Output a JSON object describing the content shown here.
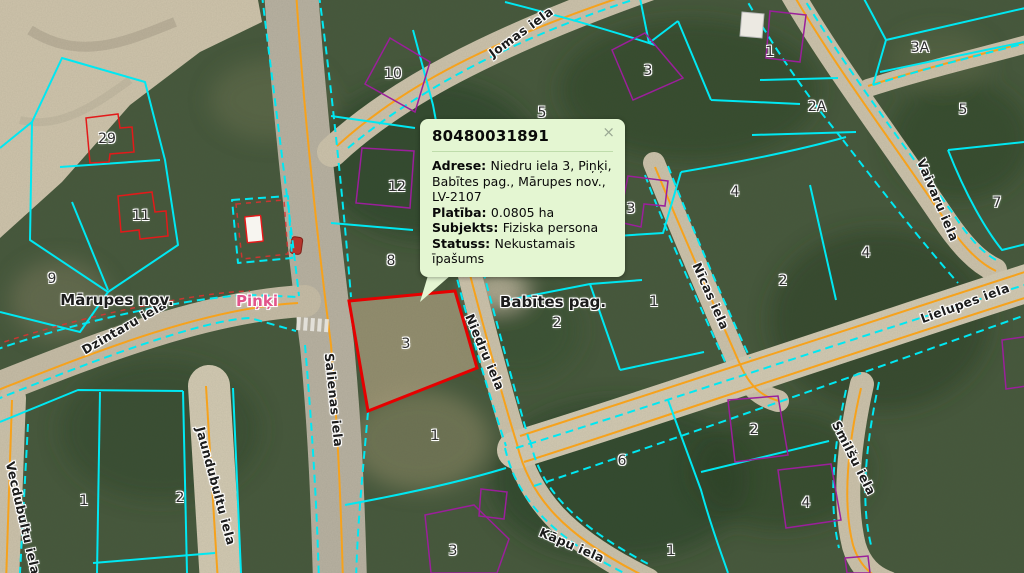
{
  "map": {
    "colors": {
      "parcel_boundary": "#00e8f2",
      "road_centerline": "#f6a21c",
      "building_outline": "#9b1f9b",
      "building_outline_red": "#e31a1a",
      "selected_parcel": "#e60000",
      "village_label": "#e2558b",
      "popup_bg": "#e4f6d2",
      "popup_border": "#bfdcab"
    },
    "place_labels": [
      {
        "text": "Mārupes nov.",
        "x": 117,
        "y": 300,
        "kind": "municipality"
      },
      {
        "text": "Piņķi",
        "x": 257,
        "y": 301,
        "kind": "village"
      },
      {
        "text": "Babītes pag.",
        "x": 553,
        "y": 302,
        "kind": "parish"
      }
    ],
    "street_labels": [
      {
        "text": "Jomas iela",
        "x": 521,
        "y": 32,
        "rot": -36
      },
      {
        "text": "Dzintaru iela",
        "x": 124,
        "y": 327,
        "rot": -30
      },
      {
        "text": "Salienas iela",
        "x": 334,
        "y": 400,
        "rot": 84
      },
      {
        "text": "Niedru iela",
        "x": 485,
        "y": 352,
        "rot": 67
      },
      {
        "text": "Nīcas iela",
        "x": 711,
        "y": 296,
        "rot": 66
      },
      {
        "text": "Vaivaru iela",
        "x": 938,
        "y": 200,
        "rot": 67
      },
      {
        "text": "Lielupes iela",
        "x": 965,
        "y": 303,
        "rot": -20
      },
      {
        "text": "Smilšu iela",
        "x": 854,
        "y": 458,
        "rot": 63
      },
      {
        "text": "Kāpu iela",
        "x": 572,
        "y": 545,
        "rot": 23
      },
      {
        "text": "Jaundubultu iela",
        "x": 216,
        "y": 486,
        "rot": 75
      },
      {
        "text": "Vecdubultu iela",
        "x": 23,
        "y": 518,
        "rot": 77
      }
    ],
    "parcel_numbers": [
      {
        "text": "29",
        "x": 107,
        "y": 139
      },
      {
        "text": "11",
        "x": 141,
        "y": 216
      },
      {
        "text": "9",
        "x": 52,
        "y": 279
      },
      {
        "text": "10",
        "x": 393,
        "y": 74
      },
      {
        "text": "12",
        "x": 397,
        "y": 187
      },
      {
        "text": "8",
        "x": 391,
        "y": 261
      },
      {
        "text": "5",
        "x": 542,
        "y": 113
      },
      {
        "text": "3",
        "x": 406,
        "y": 344
      },
      {
        "text": "1",
        "x": 435,
        "y": 436
      },
      {
        "text": "3",
        "x": 648,
        "y": 71
      },
      {
        "text": "1",
        "x": 770,
        "y": 52
      },
      {
        "text": "3A",
        "x": 920,
        "y": 48
      },
      {
        "text": "2A",
        "x": 817,
        "y": 107
      },
      {
        "text": "5",
        "x": 963,
        "y": 110
      },
      {
        "text": "4",
        "x": 735,
        "y": 192
      },
      {
        "text": "3",
        "x": 631,
        "y": 209
      },
      {
        "text": "7",
        "x": 997,
        "y": 203
      },
      {
        "text": "2",
        "x": 783,
        "y": 281
      },
      {
        "text": "4",
        "x": 866,
        "y": 253
      },
      {
        "text": "2",
        "x": 557,
        "y": 323
      },
      {
        "text": "1",
        "x": 654,
        "y": 302
      },
      {
        "text": "6",
        "x": 622,
        "y": 461
      },
      {
        "text": "2",
        "x": 754,
        "y": 430
      },
      {
        "text": "4",
        "x": 806,
        "y": 503
      },
      {
        "text": "1",
        "x": 671,
        "y": 551
      },
      {
        "text": "1",
        "x": 84,
        "y": 501
      },
      {
        "text": "2",
        "x": 180,
        "y": 498
      },
      {
        "text": "3",
        "x": 453,
        "y": 551
      }
    ]
  },
  "popup": {
    "id": "80480031891",
    "close_label": "×",
    "fields": [
      {
        "label": "Adrese:",
        "value": "Niedru iela 3, Piņķi, Babītes pag., Mārupes nov., LV-2107"
      },
      {
        "label": "Platība:",
        "value": "0.0805 ha"
      },
      {
        "label": "Subjekts:",
        "value": "Fiziska persona"
      },
      {
        "label": "Statuss:",
        "value": "Nekustamais īpašums"
      }
    ]
  }
}
